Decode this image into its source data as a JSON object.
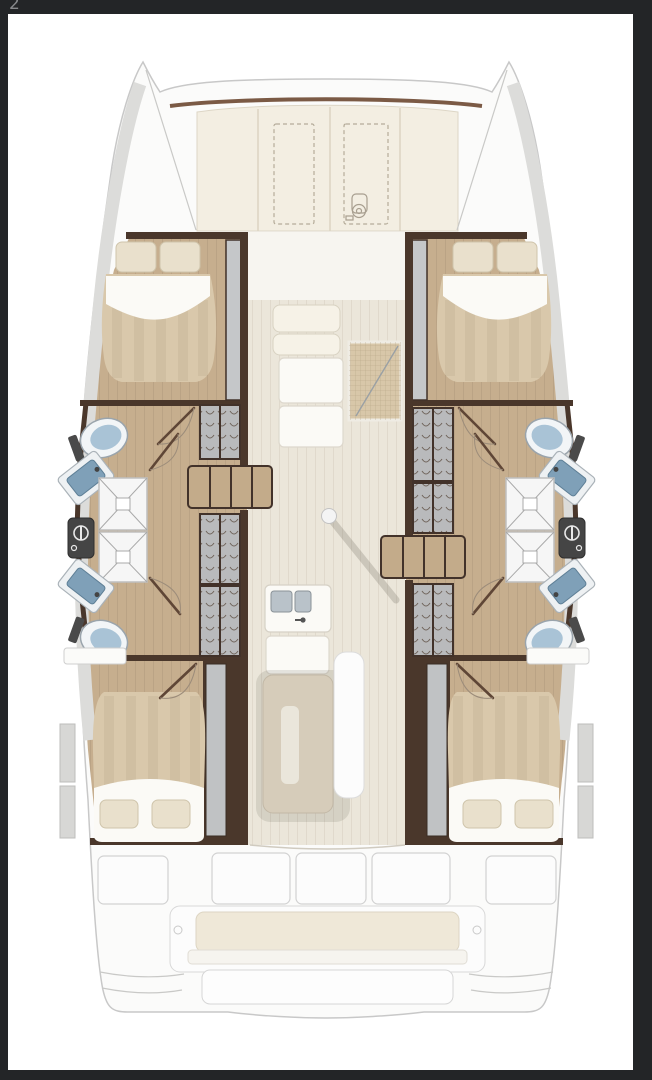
{
  "document": {
    "corner_artifact": "2"
  },
  "palette": {
    "frame": "#232527",
    "page": "#ffffff",
    "deck": "#fbfbfa",
    "crossbeam": "#7b5a45",
    "foredeck": "#f3eee2",
    "wall": "#4a372b",
    "cabin_floor": "#c6ae8e",
    "saloon_floor": "#ebe6da",
    "fwd_lounge": "#f7f5f0",
    "locker": "#b9babc",
    "step_wood": "#c3ab8a",
    "mattress": "#d9c8ab",
    "sheet": "#fbfaf6",
    "pillow": "#e9e0cc",
    "toilet": "#a9c3d6",
    "sink": "#7fa0b8",
    "shower": "#f6f6f6",
    "panel": "#454545",
    "grid_mat": "#d8c7a9",
    "counter": "#fbfaf6",
    "table": "#d6ccba",
    "table_leaf": "#eae6db",
    "bench": "#fcfcfc",
    "cushion": "#efe8d8",
    "gunwale": "#dcdcda",
    "mast": "#f4f4f4"
  },
  "icons": {
    "windlass": "windlass-icon",
    "shower_mixer": "shower-mixer-icon",
    "toilet": "toilet-icon",
    "sink": "sink-icon",
    "door_swing": "door-swing-icon"
  },
  "legend": {
    "vessel": "catamaran-floor-plan",
    "cabins": 4,
    "bathrooms": 4,
    "toilets": 4,
    "sinks": 4,
    "showers": 4,
    "wardrobes": 6,
    "hull_companionway_steps": 2,
    "saloon_galley": 1,
    "saloon_table": 1,
    "forward_deck_hatches": 2,
    "aft_cockpit_bench": 1,
    "mast_post": 1
  }
}
